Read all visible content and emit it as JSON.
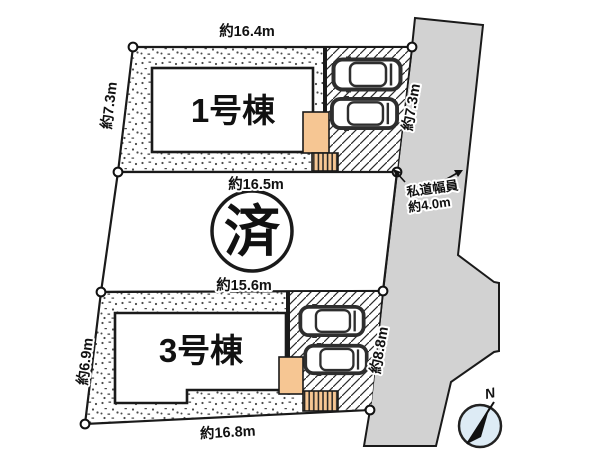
{
  "plan": {
    "lot1": {
      "name": "1号棟",
      "dim_top": "約16.4m",
      "dim_left": "約7.3m"
    },
    "lot2": {
      "status_stamp": "済",
      "dim_top": "約16.5m",
      "dim_bottom": "約15.6m"
    },
    "lot3": {
      "name": "3号棟",
      "dim_left": "約6.9m",
      "dim_bottom": "約16.8m"
    },
    "road": {
      "label_line1": "私道幅員",
      "label_line2": "約4.0m",
      "dim_upper": "約7.3m",
      "dim_lower": "約8.8m"
    },
    "compass": {
      "north_label": "N"
    }
  },
  "colors": {
    "road_fill": "#d2d2d2",
    "porch_fill": "#f6c693",
    "compass_fill": "#ddebf5",
    "line": "#1a1a1a",
    "car_stroke": "#2e2e2e"
  }
}
